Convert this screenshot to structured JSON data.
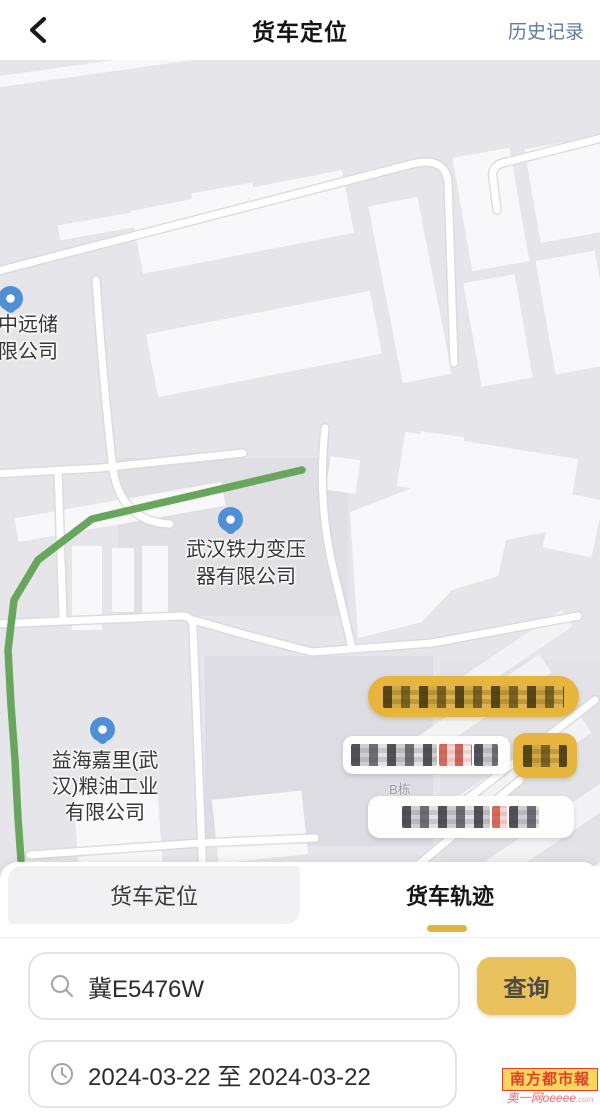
{
  "header": {
    "title": "货车定位",
    "history_link": "历史记录"
  },
  "map": {
    "route": {
      "points": "302,410 92,459 38,500 14,540 8,590 11,645 15,700 18,758 21,800",
      "color": "#68a65e"
    },
    "markers": [
      {
        "id": "cosco-storage",
        "lines": [
          "中远储",
          "限公司"
        ]
      },
      {
        "id": "wuhan-tieli-transformer",
        "lines": [
          "武汉铁力变压",
          "器有限公司"
        ]
      },
      {
        "id": "yihai-kerry-grain-oil",
        "lines": [
          "益海嘉里(武",
          "汉)粮油工业",
          "有限公司"
        ]
      }
    ],
    "building_label": "B栋",
    "redacted_overlays": [
      {
        "id": "gold-banner",
        "note": "pixelated text on gold pill"
      },
      {
        "id": "white-banner-with-red",
        "note": "pixelated text, partly red, on white pill"
      },
      {
        "id": "gold-tag",
        "note": "pixelated text on small gold pill"
      },
      {
        "id": "white-banner-2",
        "note": "pixelated text with red character on white pill"
      }
    ]
  },
  "tabs": {
    "truck_positioning": "货车定位",
    "truck_trajectory": "货车轨迹"
  },
  "search": {
    "plate_value": "冀E5476W",
    "query_label": "查询"
  },
  "date_filter": {
    "range_value": "2024-03-22 至 2024-03-22"
  },
  "watermark": {
    "brand": "南方都市報",
    "site": "奥一网oeeee",
    "site_suffix": ".com"
  },
  "colors": {
    "accent_gold": "#eac25d",
    "tab_indicator": "#e2b53e",
    "history_link": "#5e7c9f",
    "route_green": "#68a65e",
    "marker_blue": "#4e8fd6",
    "redacted_pill_gold": "#e7b53e",
    "watermark_red": "#e1402a"
  }
}
